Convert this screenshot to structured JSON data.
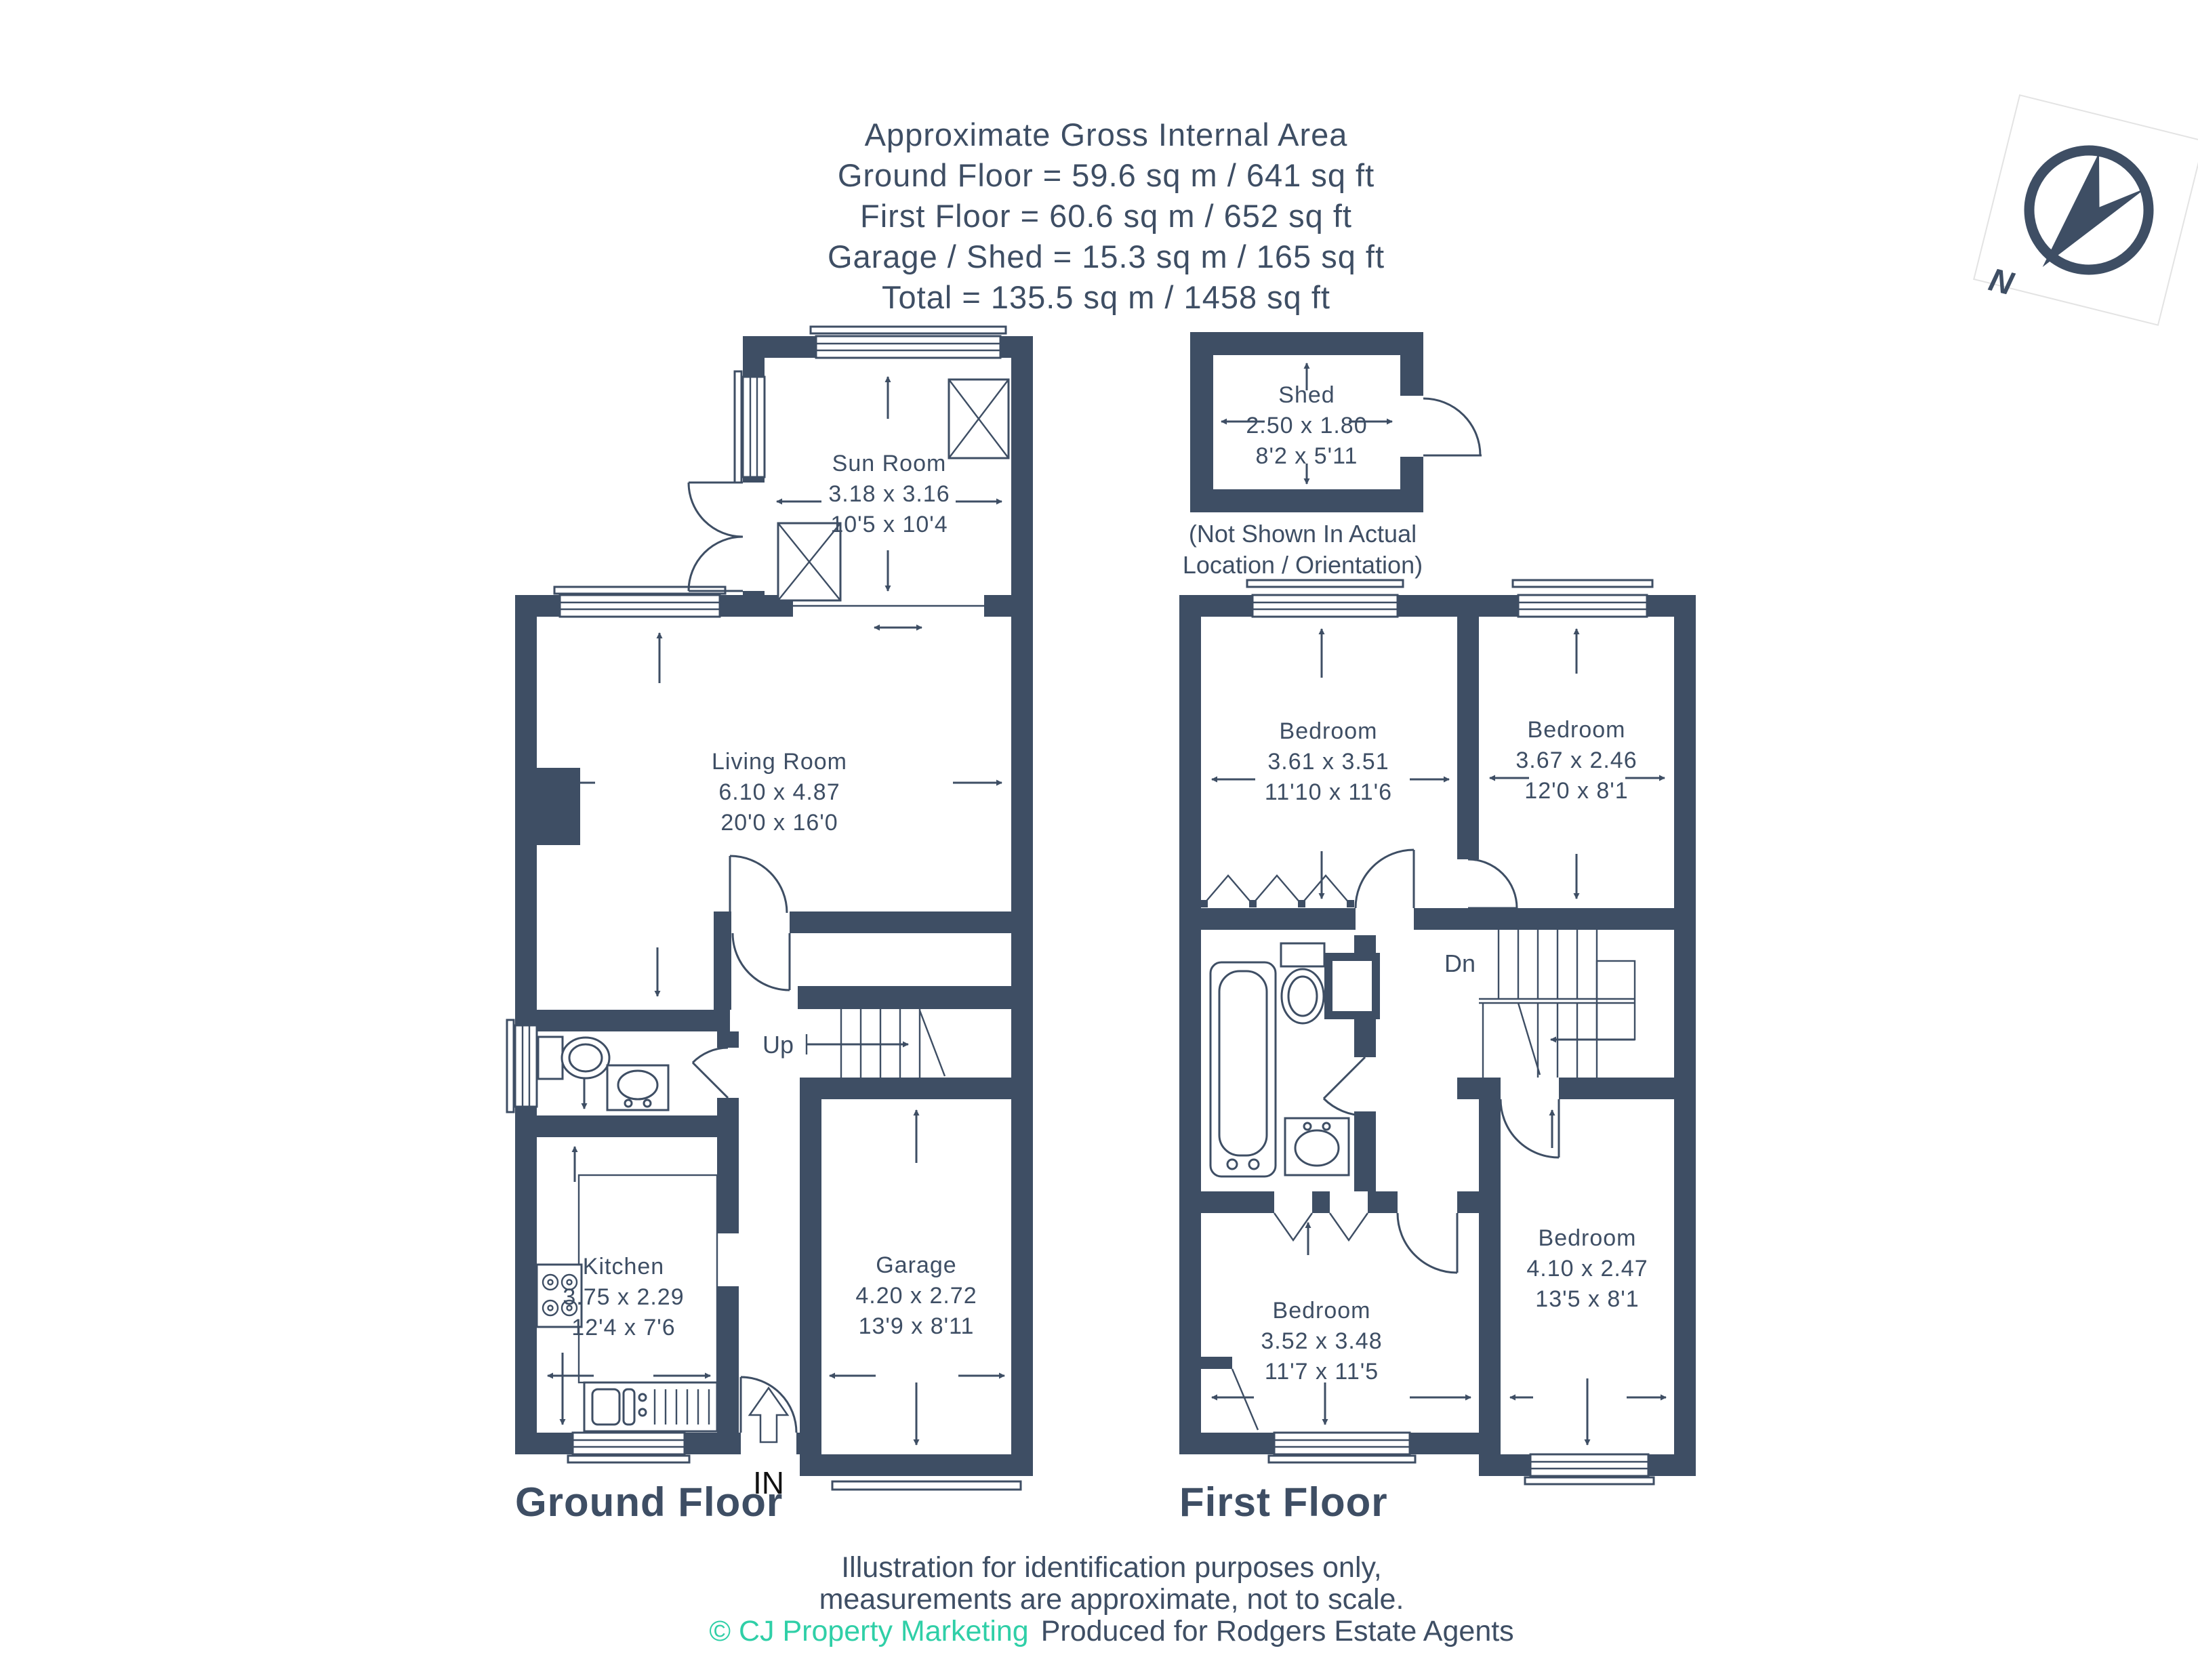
{
  "header": {
    "title": "Approximate Gross Internal Area",
    "line_ground": "Ground Floor = 59.6 sq m / 641 sq ft",
    "line_first": "First Floor = 60.6 sq m / 652 sq ft",
    "line_garage": "Garage / Shed = 15.3 sq m / 165 sq ft",
    "line_total": "Total = 135.5 sq m / 1458 sq ft"
  },
  "compass": {
    "north_label": "N"
  },
  "shed": {
    "name": "Shed",
    "dim_metric": "2.50 x 1.80",
    "dim_imperial": "8'2 x 5'11",
    "note_line1": "(Not Shown In Actual",
    "note_line2": "Location / Orientation)"
  },
  "ground_floor": {
    "title": "Ground Floor",
    "stairs_label": "Up",
    "entrance_label": "IN",
    "sun_room": {
      "name": "Sun Room",
      "dim_metric": "3.18 x 3.16",
      "dim_imperial": "10'5 x 10'4"
    },
    "living_room": {
      "name": "Living Room",
      "dim_metric": "6.10 x 4.87",
      "dim_imperial": "20'0 x 16'0"
    },
    "kitchen": {
      "name": "Kitchen",
      "dim_metric": "3.75 x 2.29",
      "dim_imperial": "12'4 x 7'6"
    },
    "garage": {
      "name": "Garage",
      "dim_metric": "4.20 x 2.72",
      "dim_imperial": "13'9 x 8'11"
    }
  },
  "first_floor": {
    "title": "First Floor",
    "stairs_label": "Dn",
    "bedroom_1": {
      "name": "Bedroom",
      "dim_metric": "3.61 x 3.51",
      "dim_imperial": "11'10 x 11'6"
    },
    "bedroom_2": {
      "name": "Bedroom",
      "dim_metric": "3.67 x 2.46",
      "dim_imperial": "12'0 x 8'1"
    },
    "bedroom_3": {
      "name": "Bedroom",
      "dim_metric": "3.52 x 3.48",
      "dim_imperial": "11'7 x 11'5"
    },
    "bedroom_4": {
      "name": "Bedroom",
      "dim_metric": "4.10 x 2.47",
      "dim_imperial": "13'5 x 8'1"
    }
  },
  "footer": {
    "disclaimer_line1": "Illustration for identification purposes only,",
    "disclaimer_line2": "measurements are approximate, not to scale.",
    "copyright": "© CJ Property Marketing",
    "produced_for": "Produced for Rodgers Estate Agents"
  },
  "colors": {
    "walls": "#3E4E64",
    "text": "#3E4E64",
    "accent": "#2FCFA7",
    "entrance_text": "#111111",
    "background": "#FFFFFF"
  }
}
